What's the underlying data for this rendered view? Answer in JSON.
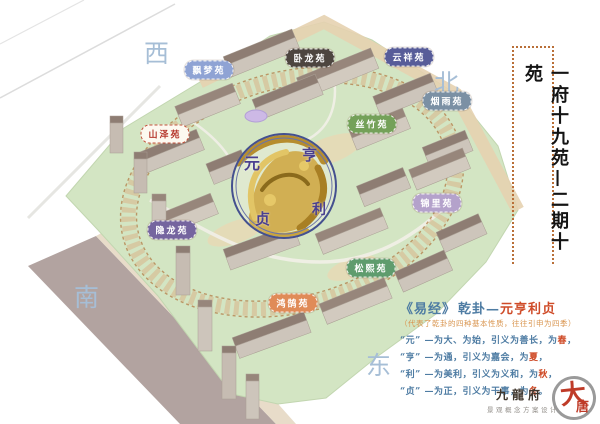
{
  "compass": {
    "west": "西",
    "north": "北",
    "south": "南",
    "east": "东"
  },
  "gardens": [
    {
      "name": "飘梦苑",
      "color": "#8fa3d4",
      "text_color": "#ffffff"
    },
    {
      "name": "卧龙苑",
      "color": "#4d453f",
      "text_color": "#ffffff"
    },
    {
      "name": "云祥苑",
      "color": "#575c99",
      "text_color": "#ffffff"
    },
    {
      "name": "烟雨苑",
      "color": "#7b90a4",
      "text_color": "#ffffff"
    },
    {
      "name": "丝竹苑",
      "color": "#74a159",
      "text_color": "#ffffff"
    },
    {
      "name": "山泽苑",
      "color": "#fdf9f0",
      "text_color": "#b5372c"
    },
    {
      "name": "锦里苑",
      "color": "#b4a2cb",
      "text_color": "#ffffff"
    },
    {
      "name": "隐龙苑",
      "color": "#75659f",
      "text_color": "#ffffff"
    },
    {
      "name": "松熙苑",
      "color": "#5f9c6d",
      "text_color": "#ffffff"
    },
    {
      "name": "鸿鹄苑",
      "color": "#e08b58",
      "text_color": "#ffffff"
    }
  ],
  "center_circle": {
    "chars": [
      "元",
      "亨",
      "利",
      "贞"
    ]
  },
  "side_title": "一府十九苑—二期十苑",
  "yijing": {
    "book": "《易经》",
    "gua": "乾卦—",
    "four": "元亨利贞",
    "note": "（代表了乾卦的四种基本性质，往往引申为四季）",
    "lines": [
      {
        "pre": "“元” —为大、为始，引义为善长，为",
        "season": "春",
        "post": "，"
      },
      {
        "pre": "“亨” —为通，引义为嘉会，为",
        "season": "夏",
        "post": "，"
      },
      {
        "pre": "“利” —为美利，引义为义和，为",
        "season": "秋",
        "post": "，"
      },
      {
        "pre": "“贞” —为正，引义为干事，为",
        "season": "冬",
        "post": "。"
      }
    ]
  },
  "logo": {
    "project": "九龍府",
    "subtitle": "景观概念方案设计",
    "seal_char_1": "大",
    "seal_char_2": "唐"
  },
  "colors": {
    "site_green": "#d3e5c3",
    "road_band": "#b2a3a0",
    "ring_tan": "#d8b488",
    "circle_border": "#44508f",
    "dragon_gold": "#c9a43e",
    "accent_red": "#cf4b28",
    "text_blue": "#4e7ca3",
    "note_orange": "#d9954f",
    "compass_blue": "#a6bed6",
    "frame_dot": "#b96f38"
  }
}
